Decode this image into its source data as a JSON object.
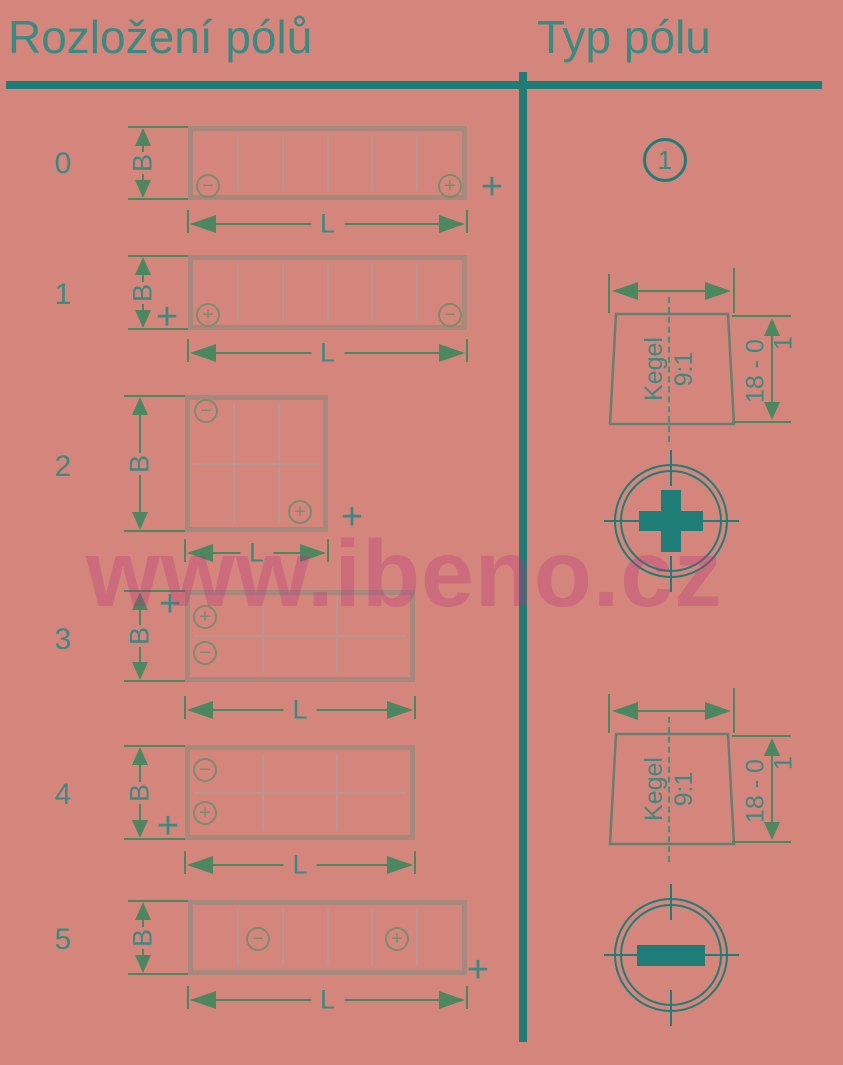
{
  "header": {
    "left": "Rozložení pólů",
    "right": "Typ pólu"
  },
  "watermark": {
    "text": "www.ibeno.cz"
  },
  "symbols": {
    "b_dim": "B",
    "l_dim": "L",
    "polarity_plus": "+",
    "terminal_plus": "+",
    "terminal_minus": "−"
  },
  "rows": [
    {
      "label": "0",
      "grid": "6x1",
      "negative": "bottom-left",
      "positive": "bottom-right"
    },
    {
      "label": "1",
      "grid": "6x1",
      "positive": "bottom-left",
      "negative": "bottom-right"
    },
    {
      "label": "2",
      "grid": "3x2",
      "negative": "top-left",
      "positive": "bottom-right"
    },
    {
      "label": "3",
      "grid": "3x2",
      "positive": "top-left",
      "negative": "middle-left"
    },
    {
      "label": "4",
      "grid": "3x2",
      "negative": "top-left",
      "positive": "bottom-left"
    },
    {
      "label": "5",
      "grid": "6x1",
      "negative": "cell-2",
      "positive": "cell-5"
    }
  ],
  "pole_type": {
    "badge": "1",
    "variants": [
      {
        "diameter": "Ø 19,5 - 0",
        "diameter_tol": "0,3",
        "cone_line1": "Kegel",
        "cone_line2": "9:1",
        "height": "18 - 0",
        "height_tol": "1",
        "terminal": "plus"
      },
      {
        "diameter": "Ø 17,9 - 0",
        "diameter_tol": "0,3",
        "cone_line1": "Kegel",
        "cone_line2": "9:1",
        "height": "18 - 0",
        "height_tol": "1",
        "terminal": "minus"
      }
    ]
  },
  "colors": {
    "background": "#d5867c",
    "divider_teal": "#1e7d76",
    "text_teal": "#3c8982",
    "dimension_green": "#4d875f",
    "box_border_gray": "#a6887d",
    "cell_line_gray": "#bb968c",
    "terminal_olive": "#7d8b6e",
    "cone_outline": "#6a7d70",
    "centerline_teal": "#4d8a7c",
    "watermark_pink": "rgba(186,52,124,0.33)"
  }
}
